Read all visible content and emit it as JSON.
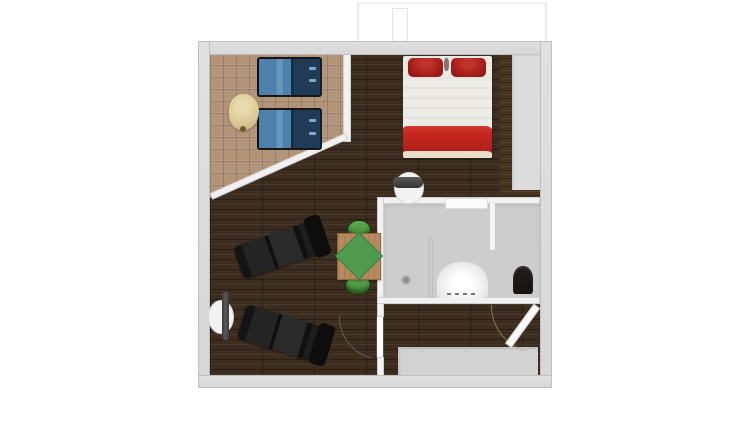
{
  "app": {
    "type": "floor-plan-3d-render",
    "background": "#ffffff",
    "visible_text": "none"
  },
  "floorplan": {
    "view": "top-down",
    "colors": {
      "bg": "#ffffff",
      "wall": "#d7d7d7",
      "wall_edge": "#bfbfbf",
      "wall_light": "#f1f1f1",
      "floor_dark": "#3c2d1f",
      "floor_parquet": "#b29478",
      "floor_bath": "#cdcdcd",
      "closet_grey": "#dcdcdc",
      "wood_trim": "#46341f",
      "bed_white": "#ebe9e3",
      "bed_red": "#c5271e",
      "pillow_red": "#a81d1b",
      "bed_cream": "#e7dfca",
      "lounger_blue": "#4d80ab",
      "lounger_navy": "#1f3b55",
      "chair_black": "#1c1c1c",
      "table_wood": "#b68a5e",
      "green": "#4f9b50",
      "stool_green": "#55a244",
      "side_table": "#d9c794",
      "toilet_black": "#211d1d",
      "mat_grey": "#d2d2d2",
      "white_fixture": "#f6f6f6"
    },
    "rooms": [
      {
        "name": "balcony",
        "floor_material": "light-parquet",
        "shape": "pentagon-with-diagonal-wall",
        "furniture": [
          "sun-lounger",
          "sun-lounger",
          "side-table"
        ]
      },
      {
        "name": "bedroom-area",
        "floor_material": "dark-hardwood",
        "furniture": [
          "double-bed-red-white",
          "closet-niche-grey",
          "wood-trim-panel"
        ]
      },
      {
        "name": "living-area",
        "floor_material": "dark-hardwood",
        "furniture": [
          "black-lounge-chair",
          "black-lounge-chair",
          "dining-table-green-runner",
          "green-stool",
          "green-stool"
        ]
      },
      {
        "name": "bathroom",
        "floor_material": "grey-tile",
        "furniture": [
          "shower-with-drain",
          "bathtub",
          "toilet",
          "wall-shelf",
          "partition-wall",
          "partition-wall"
        ]
      },
      {
        "name": "entry-hall",
        "floor_material": "dark-hardwood",
        "furniture": [
          "grey-floor-mat"
        ]
      }
    ],
    "doors": [
      "left-wall-door",
      "bathroom-round-door",
      "interior-door-with-swing-arc",
      "entry-door-open-diagonal"
    ]
  }
}
